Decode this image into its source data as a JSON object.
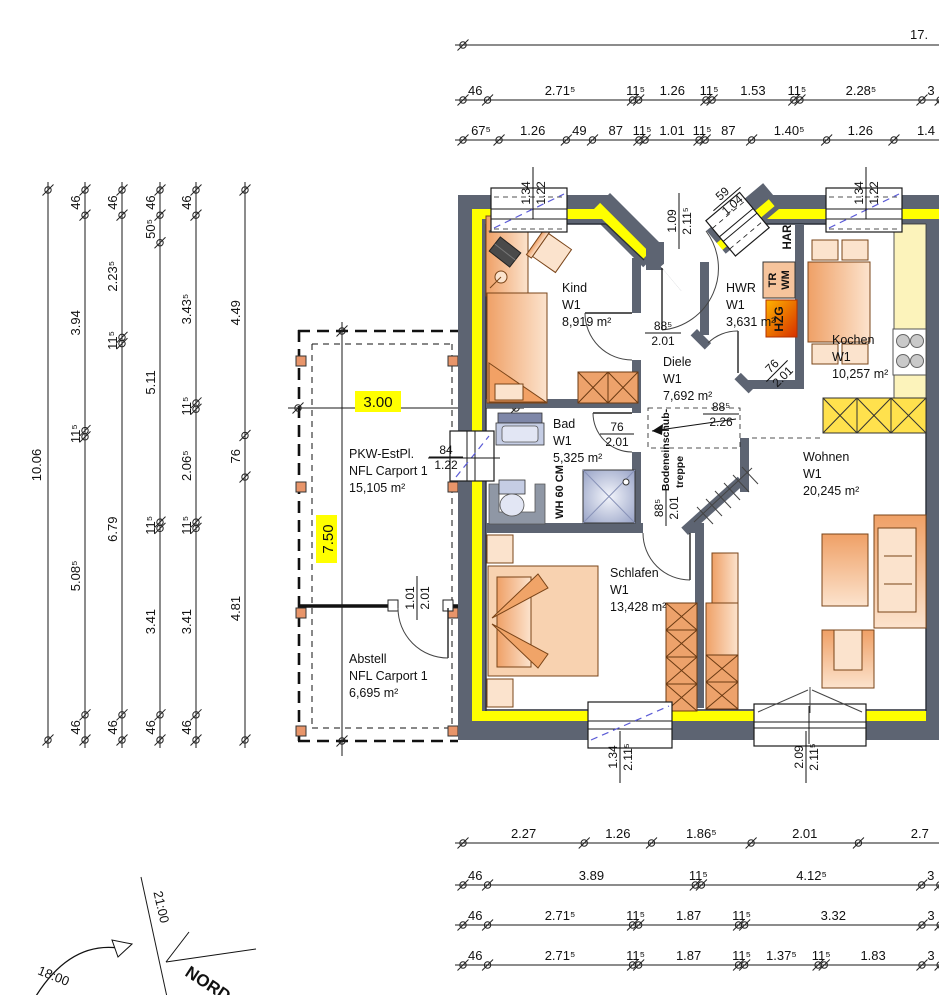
{
  "rooms": [
    {
      "name": "Kind",
      "level": "W1",
      "area": "8,919 m²"
    },
    {
      "name": "Diele",
      "level": "W1",
      "area": "7,692 m²"
    },
    {
      "name": "HWR",
      "level": "W1",
      "area": "3,631 m²"
    },
    {
      "name": "Kochen",
      "level": "W1",
      "area": "10,257 m²"
    },
    {
      "name": "Bad",
      "level": "W1",
      "area": "5,325 m²"
    },
    {
      "name": "Wohnen",
      "level": "W1",
      "area": "20,245 m²"
    },
    {
      "name": "Schlafen",
      "level": "W1",
      "area": "13,428 m²"
    },
    {
      "name": "PKW-EstPl.",
      "level": "NFL Carport 1",
      "area": "15,105 m²"
    },
    {
      "name": "Abstell",
      "level": "NFL Carport 1",
      "area": "6,695 m²"
    }
  ],
  "annotations": {
    "har": "HAR",
    "tr": "TR",
    "wm": "WM",
    "hzg": "HZG",
    "knee_wall": "WH 60 CM",
    "attic_line1": "Bodeneinschub-",
    "attic_line2": "treppe",
    "north": "NORD",
    "sun_2100": "21:00",
    "sun_1800": "18:00"
  },
  "openings": {
    "entry_door": {
      "w": "1.09",
      "h": "2.11⁵"
    },
    "entry_window": {
      "w": "59",
      "h": "1.04"
    },
    "window_top_left": {
      "w": "1.34",
      "h": "1.22"
    },
    "window_top_right": {
      "w": "1.34",
      "h": "1.22"
    },
    "window_bad": {
      "w": "84",
      "h": "1.22"
    },
    "door_kind": {
      "w": "88⁵",
      "h": "2.01"
    },
    "door_bad": {
      "w": "76",
      "h": "2.01"
    },
    "door_hwr": {
      "w": "76",
      "h": "2.01"
    },
    "door_schlafen": {
      "w": "88⁵",
      "h": "2.01"
    },
    "attic_hatch": {
      "w": "88⁵",
      "h": "2.26"
    },
    "window_schlafen": {
      "w": "1.34",
      "h": "2.11⁵"
    },
    "terrace_door": {
      "w": "2.09",
      "h": "2.11⁵"
    },
    "door_abstell": {
      "w": "1.01",
      "h": "2.01"
    }
  },
  "carport": {
    "width": "3.00",
    "depth": "7.50"
  },
  "dims": {
    "totals": {
      "top": "17.",
      "left": "10.06"
    },
    "chains": {
      "t2": [
        {
          "l": "46",
          "m": 0.46
        },
        {
          "l": "2.71⁵",
          "m": 2.715
        },
        {
          "l": "11⁵",
          "m": 0.115
        },
        {
          "l": "1.26",
          "m": 1.26
        },
        {
          "l": "11⁵",
          "m": 0.115
        },
        {
          "l": "1.53",
          "m": 1.53
        },
        {
          "l": "11⁵",
          "m": 0.115
        },
        {
          "l": "2.28⁵",
          "m": 2.285
        },
        {
          "l": "3",
          "m": 0.34
        }
      ],
      "t3": [
        {
          "l": "67⁵",
          "m": 0.675
        },
        {
          "l": "1.26",
          "m": 1.26
        },
        {
          "l": "49",
          "m": 0.49
        },
        {
          "l": "87",
          "m": 0.87
        },
        {
          "l": "11⁵",
          "m": 0.115
        },
        {
          "l": "1.01",
          "m": 1.01
        },
        {
          "l": "11⁵",
          "m": 0.115
        },
        {
          "l": "87",
          "m": 0.87
        },
        {
          "l": "1.40⁵",
          "m": 1.405
        },
        {
          "l": "1.26",
          "m": 1.26
        },
        {
          "l": "1.4",
          "m": 1.2
        }
      ],
      "l2": [
        {
          "l": "46",
          "m": 0.46
        },
        {
          "l": "3.94",
          "m": 3.94
        },
        {
          "l": "11⁵",
          "m": 0.115
        },
        {
          "l": "5.08⁵",
          "m": 5.085
        },
        {
          "l": "46",
          "m": 0.46
        }
      ],
      "l3": [
        {
          "l": "46",
          "m": 0.46
        },
        {
          "l": "2.23⁵",
          "m": 2.235
        },
        {
          "l": "11⁵",
          "m": 0.115
        },
        {
          "l": "6.79",
          "m": 6.79
        },
        {
          "l": "46",
          "m": 0.46
        }
      ],
      "l4": [
        {
          "l": "46",
          "m": 0.46
        },
        {
          "l": "50⁵",
          "m": 0.505
        },
        {
          "l": "5.11",
          "m": 5.11
        },
        {
          "l": "11⁵",
          "m": 0.115
        },
        {
          "l": "3.41",
          "m": 3.41
        },
        {
          "l": "46",
          "m": 0.46
        }
      ],
      "l5": [
        {
          "l": "46",
          "m": 0.46
        },
        {
          "l": "3.43⁵",
          "m": 3.435
        },
        {
          "l": "11⁵",
          "m": 0.115
        },
        {
          "l": "2.06⁵",
          "m": 2.065
        },
        {
          "l": "11⁵",
          "m": 0.115
        },
        {
          "l": "3.41",
          "m": 3.41
        },
        {
          "l": "46",
          "m": 0.46
        }
      ],
      "l6": [
        {
          "l": "4.49",
          "m": 4.49
        },
        {
          "l": "76",
          "m": 0.76
        },
        {
          "l": "4.81",
          "m": 4.81
        }
      ],
      "b1": [
        {
          "l": "2.27",
          "m": 2.27
        },
        {
          "l": "1.26",
          "m": 1.26
        },
        {
          "l": "1.86⁵",
          "m": 1.865
        },
        {
          "l": "2.01",
          "m": 2.01
        },
        {
          "l": "2.7",
          "m": 2.3
        }
      ],
      "b2": [
        {
          "l": "46",
          "m": 0.46
        },
        {
          "l": "3.89",
          "m": 3.89
        },
        {
          "l": "11⁵",
          "m": 0.115
        },
        {
          "l": "4.12⁵",
          "m": 4.125
        },
        {
          "l": "3",
          "m": 0.34
        }
      ],
      "b3": [
        {
          "l": "46",
          "m": 0.46
        },
        {
          "l": "2.71⁵",
          "m": 2.715
        },
        {
          "l": "11⁵",
          "m": 0.115
        },
        {
          "l": "1.87",
          "m": 1.87
        },
        {
          "l": "11⁵",
          "m": 0.115
        },
        {
          "l": "3.32",
          "m": 3.32
        },
        {
          "l": "3",
          "m": 0.34
        }
      ],
      "b4": [
        {
          "l": "46",
          "m": 0.46
        },
        {
          "l": "2.71⁵",
          "m": 2.715
        },
        {
          "l": "11⁵",
          "m": 0.115
        },
        {
          "l": "1.87",
          "m": 1.87
        },
        {
          "l": "11⁵",
          "m": 0.115
        },
        {
          "l": "1.37⁵",
          "m": 1.375
        },
        {
          "l": "11⁵",
          "m": 0.115
        },
        {
          "l": "1.83",
          "m": 1.83
        },
        {
          "l": "3",
          "m": 0.34
        }
      ]
    }
  }
}
